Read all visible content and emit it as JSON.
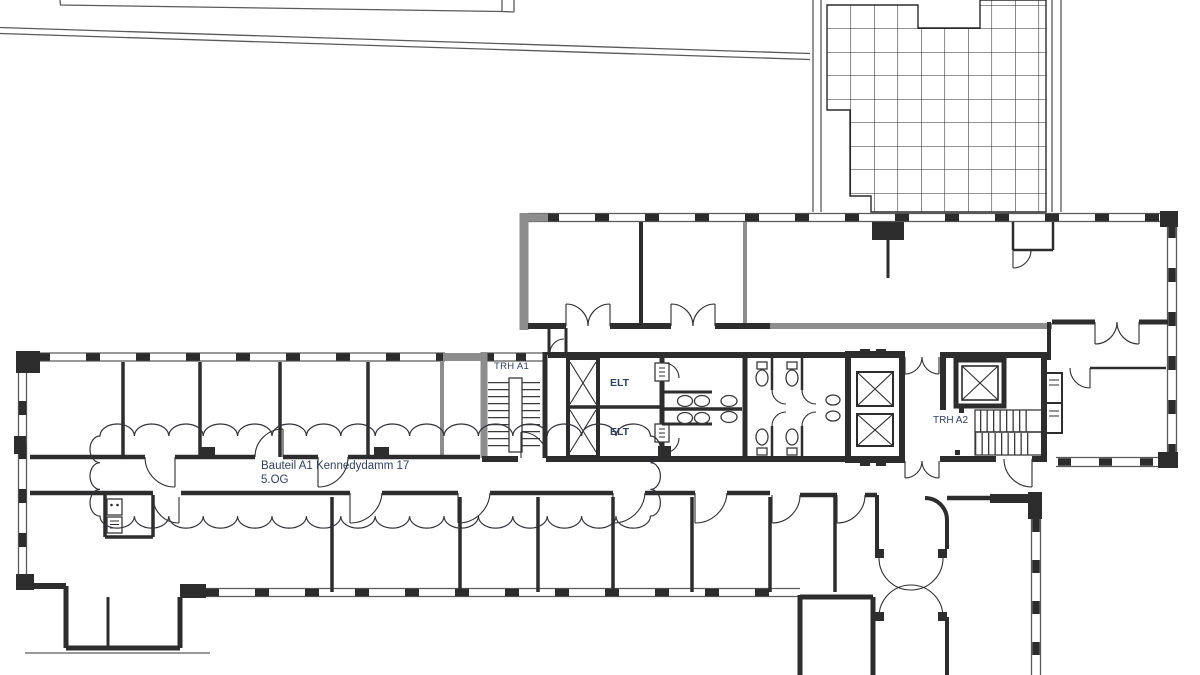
{
  "drawing": {
    "type": "architectural-floor-plan",
    "labels": {
      "building": {
        "line1": "Bauteil A1 Kennedydamm 17",
        "line2": "5.OG"
      },
      "stairwell_a1": "TRH A1",
      "stairwell_a2": "TRH A2",
      "elt_top": "ELT",
      "elt_bottom": "ELT"
    },
    "colors": {
      "background": "#ffffff",
      "wall_dark": "#2d2d2d",
      "wall_gray": "#8d8d8d",
      "thin_line": "#5a5a5a",
      "label_text": "#31405e"
    }
  }
}
